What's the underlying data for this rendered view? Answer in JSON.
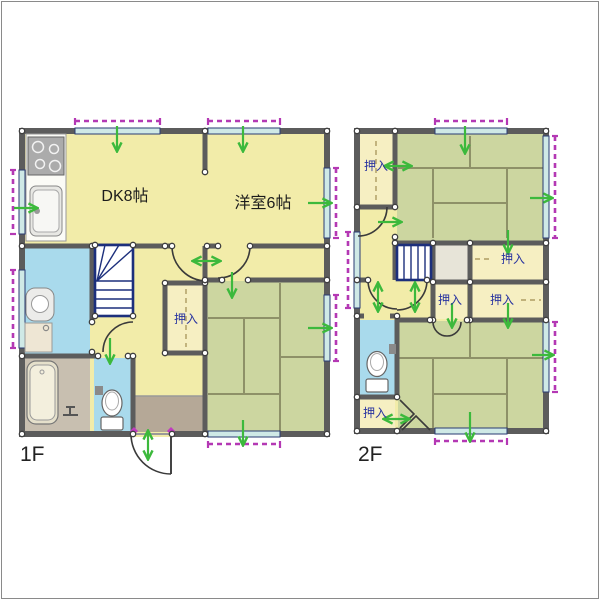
{
  "image": {
    "type": "residential-floor-plan",
    "background": "#ffffff",
    "frame_color": "#8a8a8a"
  },
  "floor1": {
    "label": "1F",
    "rooms": {
      "dining_kitchen": "DK8帖",
      "western_room": "洋室6帖",
      "closet": "押入"
    }
  },
  "floor2": {
    "label": "2F",
    "closets": [
      "押入",
      "押入",
      "押入",
      "押入",
      "押入"
    ]
  },
  "colors": {
    "wall": "#5c5c5c",
    "room_floor_yellow": "#f2eca9",
    "tatami_green": "#ccd6a0",
    "closet_floor": "#f6efc2",
    "wet_area_blue": "#a9daec",
    "bath_floor_gray": "#c8bfb0",
    "entrance_tataki": "#b5a897",
    "window_glass": "#cfe9e6",
    "window_dash_magenta": "#b438b4",
    "stairs_border_navy": "#1c2f7c",
    "airflow_green": "#3cb93c",
    "closet_label_navy": "#2a35a0"
  }
}
